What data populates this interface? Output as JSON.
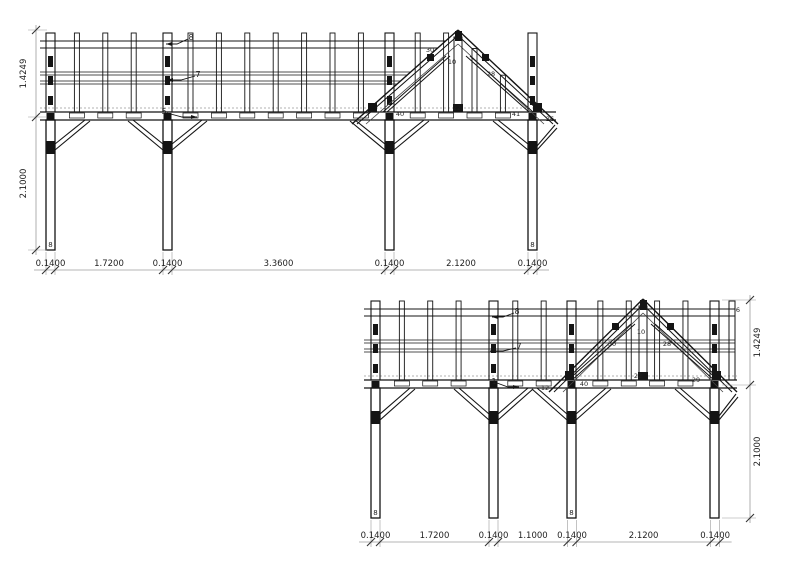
{
  "colors": {
    "line": "#141414",
    "dim_line": "#9b9b9b",
    "text": "#1e1e1e"
  },
  "elevations": [
    {
      "name": "side-elevation-a",
      "bottom_dims": [
        "0.1400",
        "1.7200",
        "0.1400",
        "3.3600",
        "0.1400",
        "2.1200",
        "0.1400"
      ],
      "vertical_dims": [
        "1.4249",
        "2.1000"
      ],
      "leader_labels": [
        {
          "text": "8",
          "x": 191,
          "y": 37,
          "tx": 166,
          "ty": 44
        },
        {
          "text": "7",
          "x": 198,
          "y": 74,
          "tx": 167,
          "ty": 80
        },
        {
          "text": "5",
          "x": 164,
          "y": 111,
          "tx": 197,
          "ty": 117
        }
      ],
      "part_labels": [
        {
          "text": "30",
          "x": 430,
          "y": 52
        },
        {
          "text": "10",
          "x": 452,
          "y": 64
        },
        {
          "text": "28",
          "x": 491,
          "y": 76
        },
        {
          "text": "22",
          "x": 457,
          "y": 110
        },
        {
          "text": "26",
          "x": 550,
          "y": 121
        },
        {
          "text": "40",
          "x": 400,
          "y": 116
        },
        {
          "text": "41",
          "x": 516,
          "y": 116
        }
      ],
      "post_base_labels": [
        {
          "text": "8",
          "post": 0
        },
        {
          "text": "8",
          "post": 3
        }
      ]
    },
    {
      "name": "side-elevation-b",
      "bottom_dims": [
        "0.1400",
        "1.7200",
        "0.1400",
        "1.1000",
        "0.1400",
        "2.1200",
        "0.1400"
      ],
      "vertical_dims": [
        "1.4249",
        "2.1000"
      ],
      "leader_labels": [
        {
          "text": "8",
          "x": 517,
          "y": 311,
          "tx": 492,
          "ty": 317
        },
        {
          "text": "7",
          "x": 519,
          "y": 346,
          "tx": 490,
          "ty": 351
        },
        {
          "text": "1",
          "x": 494,
          "y": 381,
          "tx": 519,
          "ty": 387
        }
      ],
      "part_labels": [
        {
          "text": "6",
          "x": 738,
          "y": 312
        },
        {
          "text": "30",
          "x": 612,
          "y": 346
        },
        {
          "text": "10",
          "x": 641,
          "y": 334
        },
        {
          "text": "28",
          "x": 667,
          "y": 346
        },
        {
          "text": "22",
          "x": 638,
          "y": 378
        },
        {
          "text": "40",
          "x": 584,
          "y": 386
        },
        {
          "text": "12",
          "x": 545,
          "y": 390
        },
        {
          "text": "29",
          "x": 696,
          "y": 382
        }
      ],
      "post_base_labels": [
        {
          "text": "8",
          "post": 0
        },
        {
          "text": "8",
          "post": 2
        }
      ]
    }
  ]
}
